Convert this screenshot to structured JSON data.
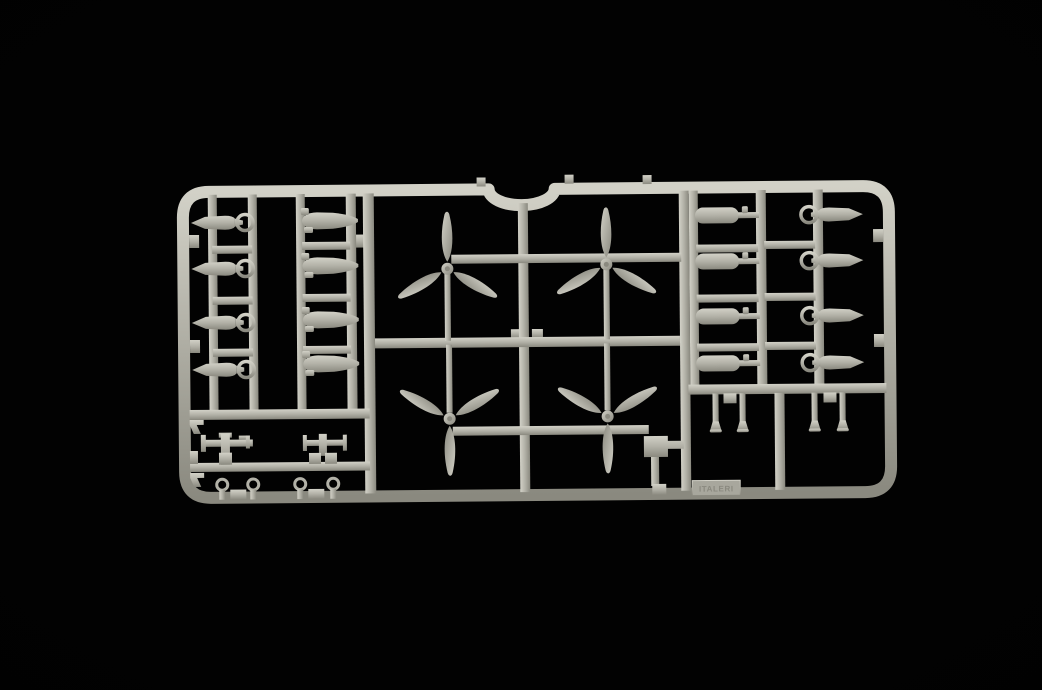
{
  "scene": {
    "description": "Photograph of a light grey injection-moulded plastic model kit sprue (runner frame) holding aircraft parts, lit against a black background",
    "label_plate_text": "ITALERI"
  },
  "colors": {
    "background": "#020202",
    "plastic-mid": "#b2b1a7",
    "plastic-highlight": "#d2d1c7",
    "plastic-shadow": "#8a897f",
    "plastic-deep": "#6e6d64",
    "plate": "#a8a79d"
  },
  "parts_inventory": [
    {
      "part": "three-blade propeller",
      "count": 4
    },
    {
      "part": "bomb with ring tail fin",
      "count": 8
    },
    {
      "part": "drop tank",
      "count": 8
    },
    {
      "part": "underwing bomb rack",
      "count": 2
    },
    {
      "part": "mounting hook",
      "count": 2
    },
    {
      "part": "towing eyelet",
      "count": 4
    },
    {
      "part": "landing-gear strut",
      "count": 4
    },
    {
      "part": "stepped bracket",
      "count": 1
    },
    {
      "part": "embossed manufacturer plate",
      "count": 1
    }
  ]
}
